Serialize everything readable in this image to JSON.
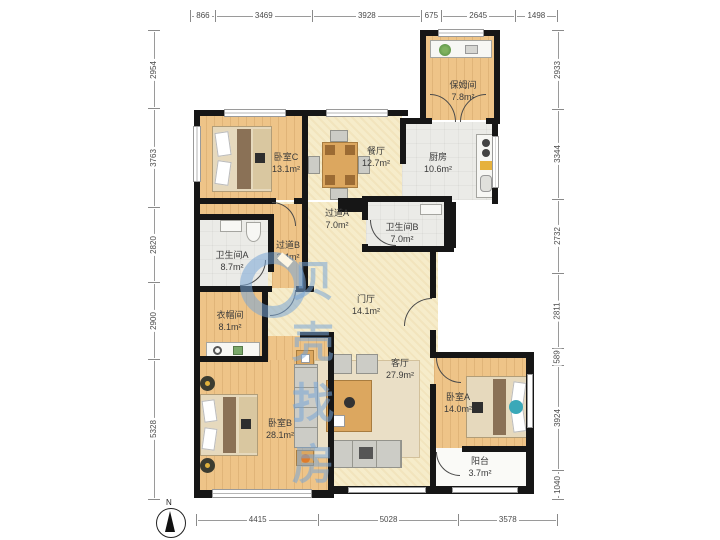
{
  "watermark": {
    "text": "贝壳找房"
  },
  "compass": {
    "label": "N"
  },
  "dimensions": {
    "top": [
      "866",
      "3469",
      "3928",
      "675",
      "2645",
      "1498"
    ],
    "bottom": [
      "4415",
      "5028",
      "3578"
    ],
    "left": [
      "2954",
      "3763",
      "2820",
      "2900",
      "5328"
    ],
    "right": [
      "2933",
      "3344",
      "2732",
      "2811",
      "589",
      "3924",
      "1040"
    ]
  },
  "rooms": {
    "baomujian": {
      "name": "保姆间",
      "area": "7.8m²"
    },
    "chufang": {
      "name": "厨房",
      "area": "10.6m²"
    },
    "canting": {
      "name": "餐厅",
      "area": "12.7m²"
    },
    "woshiC": {
      "name": "卧室C",
      "area": "13.1m²"
    },
    "guodaoA": {
      "name": "过道A",
      "area": "7.0m²"
    },
    "weishengjianB": {
      "name": "卫生间B",
      "area": "7.0m²"
    },
    "guodaoB": {
      "name": "过道B",
      "area": "3.4m²"
    },
    "weishengjianA": {
      "name": "卫生间A",
      "area": "8.7m²"
    },
    "menting": {
      "name": "门厅",
      "area": "14.1m²"
    },
    "yimaojian": {
      "name": "衣帽间",
      "area": "8.1m²"
    },
    "keting": {
      "name": "客厅",
      "area": "27.9m²"
    },
    "woshiB": {
      "name": "卧室B",
      "area": "28.1m²"
    },
    "woshiA": {
      "name": "卧室A",
      "area": "14.0m²"
    },
    "yangtai": {
      "name": "阳台",
      "area": "3.7m²"
    }
  },
  "colors": {
    "wall": "#161616",
    "wood": "#eec488",
    "tile": "#ebebe7",
    "floor": "#f6ecca",
    "watermark": "#78a5d7"
  }
}
